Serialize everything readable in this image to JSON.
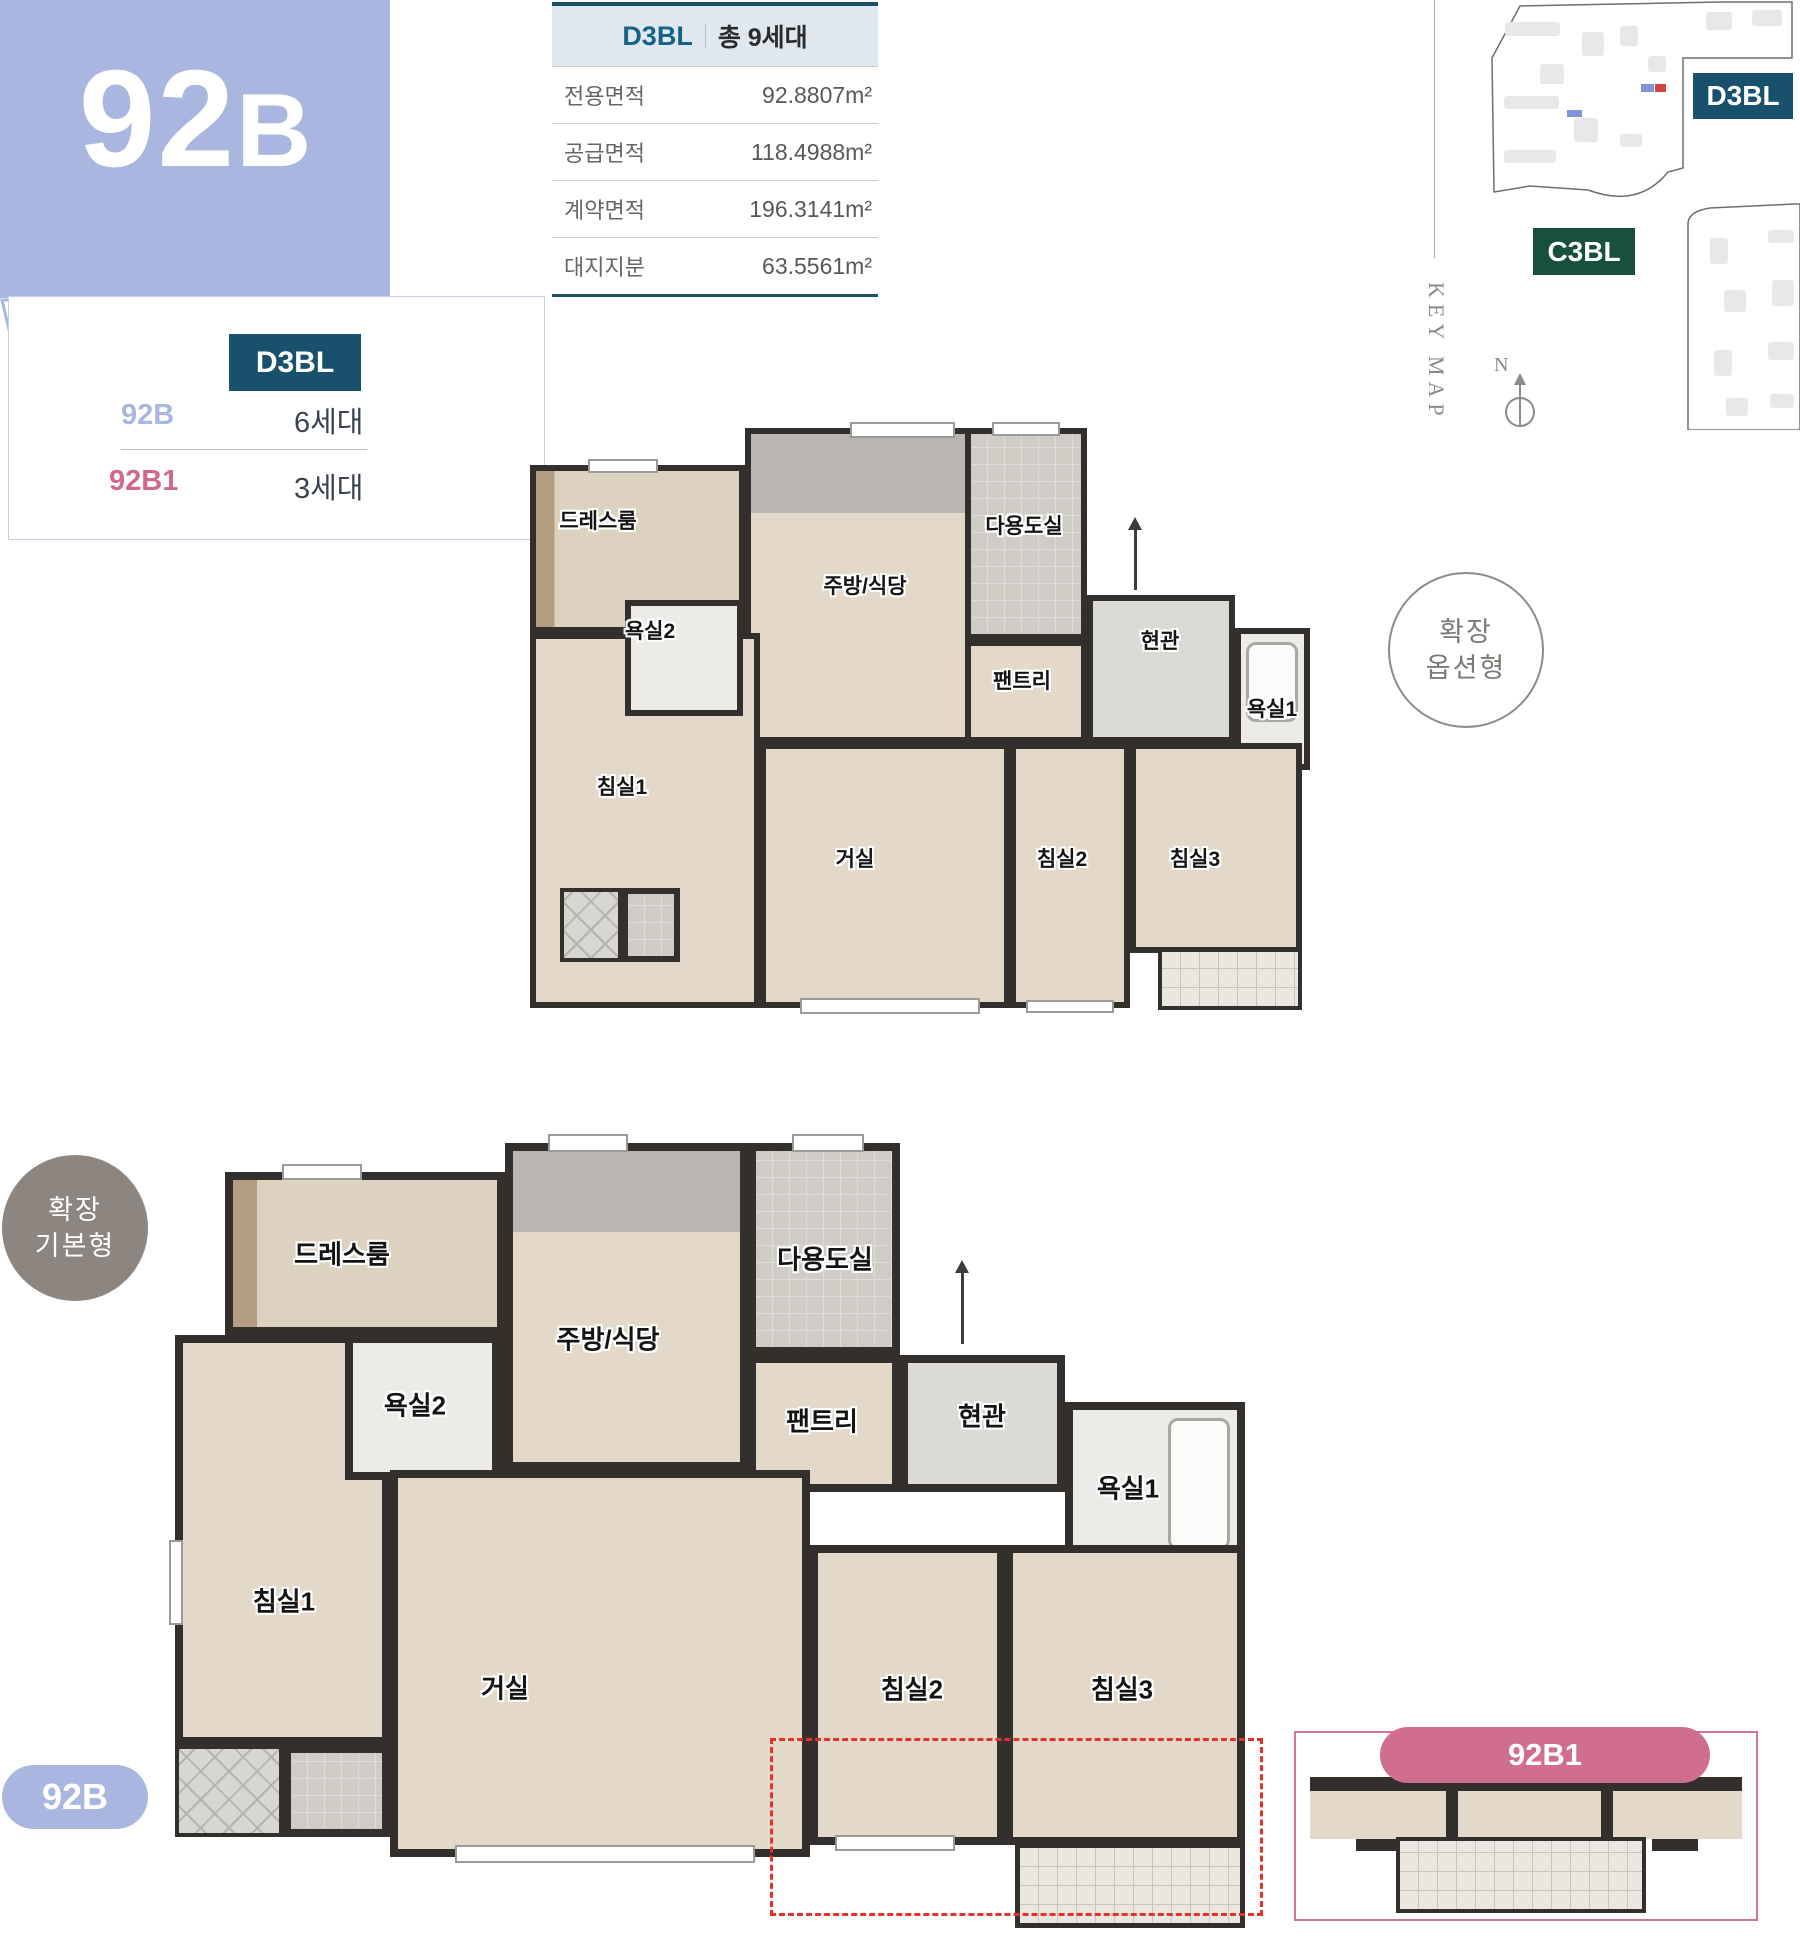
{
  "unit_header": {
    "code_main": "92",
    "code_suffix": "B",
    "bubble_color": "#a9b7e0"
  },
  "unit_card": {
    "block_badge": "D3BL",
    "badge_color": "#19516d",
    "rows": [
      {
        "type": "92B",
        "households": "6세대",
        "type_color": "#a9b7e0"
      },
      {
        "type": "92B1",
        "households": "3세대",
        "type_color": "#d06a8c"
      }
    ]
  },
  "area_table": {
    "block": "D3BL",
    "total": "총 9세대",
    "accent_color": "#1c5068",
    "rows": [
      {
        "label": "전용면적",
        "value": "92.8807m²"
      },
      {
        "label": "공급면적",
        "value": "118.4988m²"
      },
      {
        "label": "계약면적",
        "value": "196.3141m²"
      },
      {
        "label": "대지지분",
        "value": "63.5561m²"
      }
    ]
  },
  "key_map": {
    "title": "KEY MAP",
    "north": "N",
    "badges": [
      {
        "label": "D3BL",
        "color": "#19516d"
      },
      {
        "label": "C3BL",
        "color": "#17503c"
      }
    ]
  },
  "room_labels": {
    "dressroom": "드레스룸",
    "bath2": "욕실2",
    "kitchen": "주방/식당",
    "utility": "다용도실",
    "pantry": "팬트리",
    "entrance": "현관",
    "bath1": "욕실1",
    "bed1": "침실1",
    "living": "거실",
    "bed2": "침실2",
    "bed3": "침실3"
  },
  "plan_option": {
    "badge_line1": "확장",
    "badge_line2": "옵션형"
  },
  "plan_basic": {
    "badge_line1": "확장",
    "badge_line2": "기본형",
    "tag": "92B",
    "inset_tag": "92B1"
  }
}
